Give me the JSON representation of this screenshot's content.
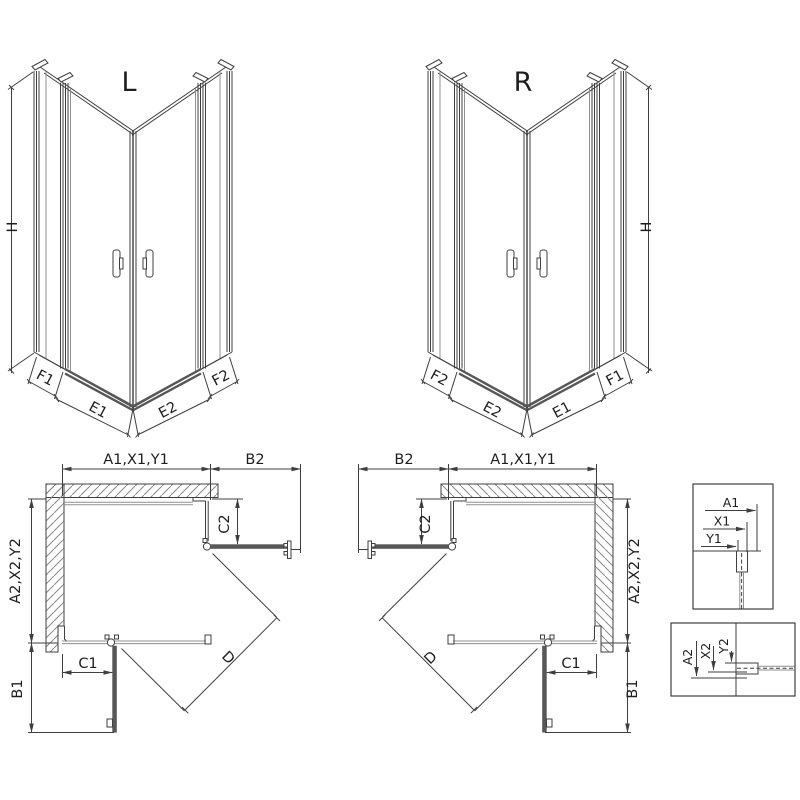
{
  "iso_left": {
    "title": "L",
    "height_label": "H",
    "fixed_left": "F1",
    "door_left": "E1",
    "door_right": "E2",
    "fixed_right": "F2"
  },
  "iso_right": {
    "title": "R",
    "height_label": "H",
    "fixed_left": "F2",
    "door_left": "E2",
    "door_right": "E1",
    "fixed_right": "F1"
  },
  "plan_left": {
    "width_label": "A1,X1,Y1",
    "side_label": "B2",
    "offset_top": "C2",
    "depth_label": "A2,X2,Y2",
    "offset_bottom": "C1",
    "door_proj": "B1",
    "diagonal": "D"
  },
  "plan_right": {
    "width_label": "A1,X1,Y1",
    "side_label": "B2",
    "offset_top": "C2",
    "depth_label": "A2,X2,Y2",
    "offset_bottom": "C1",
    "door_proj": "B1",
    "diagonal": "D"
  },
  "detail_top": {
    "dims": [
      "A1",
      "X1",
      "Y1"
    ]
  },
  "detail_bottom": {
    "dims": [
      "A2",
      "X2",
      "Y2"
    ]
  },
  "colors": {
    "line": "#3f3f3f",
    "glass": "#8f8f8f",
    "thick": "#575757",
    "hatch": "#8a8a8a",
    "text": "#1e1e1e"
  }
}
